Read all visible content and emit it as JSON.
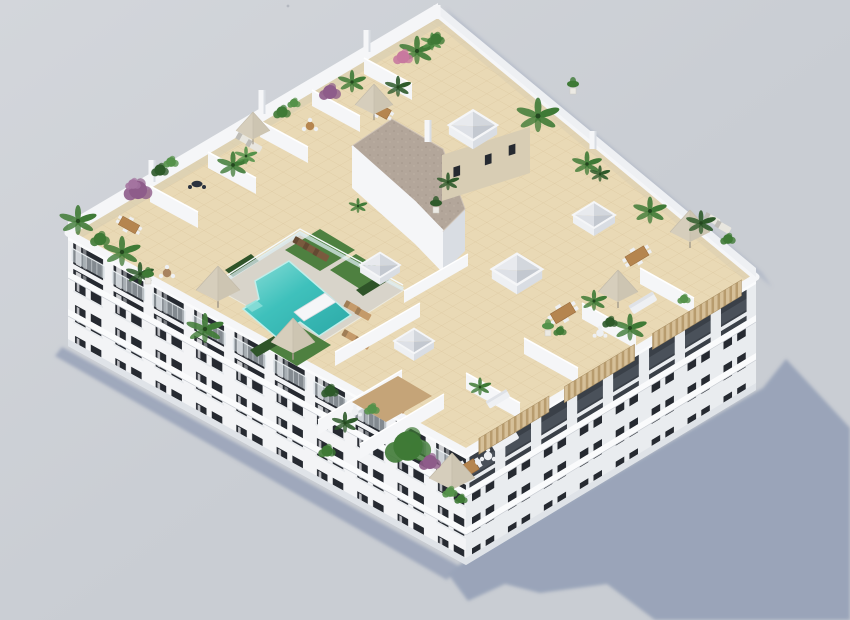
{
  "scene": {
    "type": "3d-architectural-render",
    "subject": "Aerial isometric render of a white apartment block rooftop solarium with communal pool, lawns, tiled terraces, parasols and palm trees, casting a shadow to the lower right",
    "elements": [
      "apartment building",
      "rooftop terraces",
      "L-shaped swimming pool",
      "glass pool fence",
      "artificial lawn",
      "sun loungers",
      "beige parasols",
      "palm trees",
      "bougainvillea bushes",
      "pyramidal skylights",
      "stair core with gravel roof",
      "wooden pergola over top-floor balconies",
      "dining sets",
      "ground shadow"
    ],
    "counts": {
      "visible_floors": 3,
      "skylights": 5,
      "parasols": 7,
      "palm_trees": 21,
      "pools": 1
    }
  },
  "colors": {
    "background": "#c9cdd3",
    "background_hi": "#d3d6db",
    "shadow": "#9aa4b9",
    "shadow_deep": "#a8b0c3",
    "roof_tile": "#e9d9b5",
    "tile_grout": "#d9c49c",
    "tile_shadow": "#d9ceb2",
    "deck": "#d8d4ca",
    "lawn": "#4e8040",
    "lawn_light": "#5f9149",
    "hedge": "#2f5429",
    "pool": "#3fc1bc",
    "pool_light": "#8fe0da",
    "pool_deep": "#2ba8a6",
    "wall_bright": "#f5f6f8",
    "wall_light": "#eef0f3",
    "wall_mid": "#e3e6ea",
    "wall_shade": "#d9dde3",
    "facade_sw": "#f3f4f6",
    "facade_se": "#e9ecef",
    "slab": "#fafbfc",
    "base_shade": "#dfe3e8",
    "window_dark": "#262a31",
    "window_recess": "#3a4048",
    "railing": "#cfd9dd",
    "gravel": "#b3a69a",
    "gravel_dot": "#a29589",
    "tan_wall": "#d8cdb4",
    "pergola": "#d6c099",
    "pergola_dark": "#b89c6e",
    "wood": "#b5854f",
    "wood_dark": "#96693c",
    "rattan": "#a8835f",
    "parasol_hi": "#efe9dc",
    "parasol_md": "#ded7c6",
    "parasol_md2": "#d6cebc",
    "parasol_lo": "#cdc5b2",
    "pole": "#a39b8c",
    "furn_white": "#eef0f3",
    "furn_dark": "#2b333f",
    "plant_dark": "#2e5a2a",
    "plant_mid": "#3f7a36",
    "plant_light": "#55924a",
    "purple": "#8e5c8a",
    "purple_hi": "#a474a0",
    "pink": "#c8799f",
    "pot": "#eceae4",
    "trunk": "#8a6a4c",
    "fence": "#ddeef2"
  }
}
